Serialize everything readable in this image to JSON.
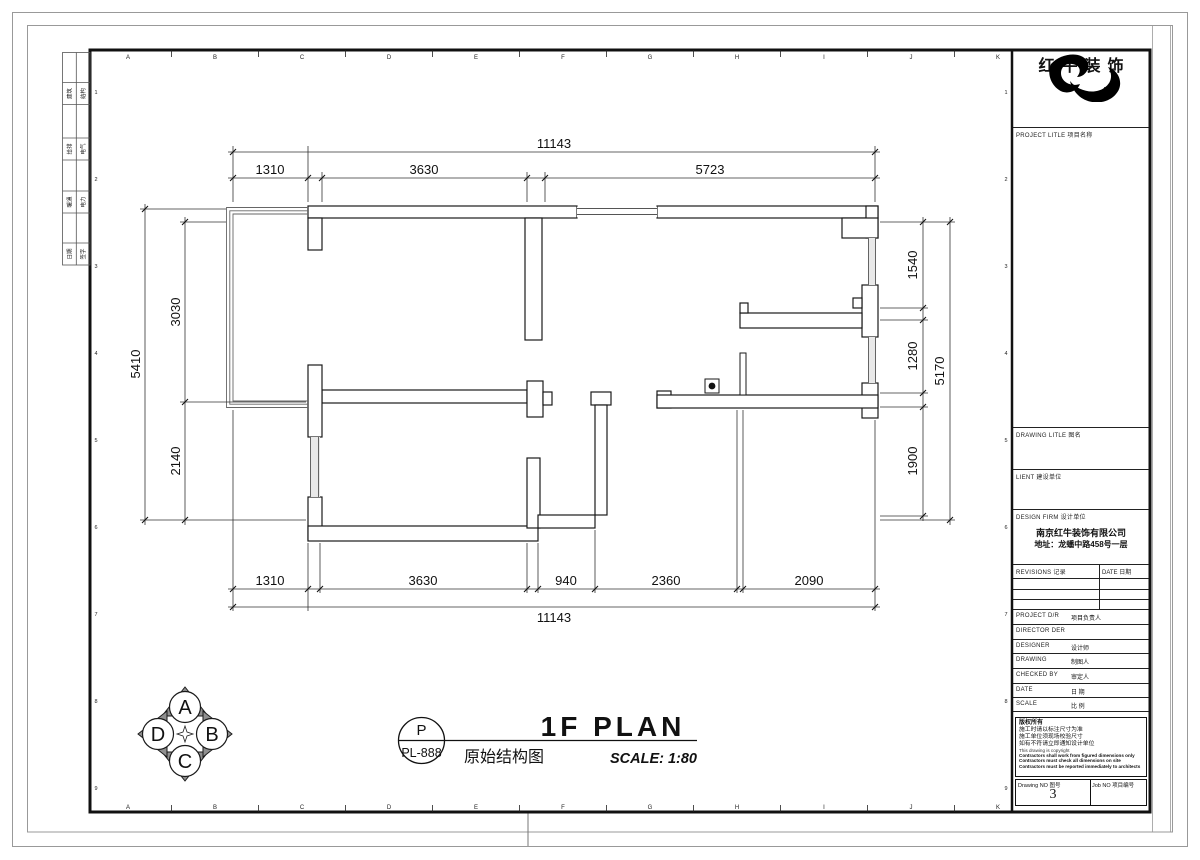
{
  "sheet": {
    "brand": "红牛装饰",
    "grid_letters": [
      "A",
      "B",
      "C",
      "D",
      "E",
      "F",
      "G",
      "H",
      "I",
      "J",
      "K"
    ],
    "row_numbers": [
      "1",
      "2",
      "3",
      "4",
      "5",
      "6",
      "7",
      "8",
      "9"
    ],
    "signature_strip": [
      [
        "建筑",
        "结构"
      ],
      [
        "给排",
        "电气"
      ],
      [
        "暖通",
        "电力"
      ],
      [
        "日期",
        "签字"
      ]
    ]
  },
  "plan": {
    "dim_top_total": "11143",
    "dim_top": [
      "1310",
      "3630",
      "5723"
    ],
    "dim_bottom": [
      "1310",
      "3630",
      "940",
      "2360",
      "2090"
    ],
    "dim_bottom_total": "11143",
    "dim_left_outer": "5410",
    "dim_left": [
      "3030",
      "2140"
    ],
    "dim_right": [
      "1540",
      "1280",
      "1900"
    ],
    "dim_right_outer": "5170"
  },
  "title_bar": {
    "ref_top": "P",
    "ref_bottom": "PL-888",
    "title_en": "1F PLAN",
    "title_cn": "原始结构图",
    "scale": "SCALE: 1:80"
  },
  "compass": {
    "top": "A",
    "right": "B",
    "bottom": "C",
    "left": "D"
  },
  "title_block": {
    "project_label": "PROJECT LITLE 项目名称",
    "drawing_label": "DRAWING LITLE 图名",
    "client_label": "LIENT 建设单位",
    "design_firm_label": "DESIGN FIRM 设计单位",
    "design_firm_name": "南京红牛装饰有限公司",
    "design_firm_addr": "地址：龙蟠中路458号一层",
    "revisions_label": "REVISIONS 记录",
    "date_col_label": "DATE 日期",
    "rows": [
      {
        "label": "PROJECT D/R",
        "cn": "项目负责人"
      },
      {
        "label": "DIRECTOR DER",
        "cn": ""
      },
      {
        "label": "DESIGNER",
        "cn": "设计师"
      },
      {
        "label": "DRAWING",
        "cn": "制图人"
      },
      {
        "label": "CHECKED BY",
        "cn": "审定人"
      },
      {
        "label": "DATE",
        "cn": "日  期"
      },
      {
        "label": "SCALE",
        "cn": "比  例"
      }
    ],
    "copyright_cn_title": "版权所有",
    "notes_cn": [
      "施工时请以标注尺寸为准",
      "施工单位须现场校验尺寸",
      "如有不符请立即通知设计单位"
    ],
    "copyright_en": "This drawing is copyright",
    "notes_en": [
      "Contractors shall work from figured dimensions only",
      "Contractors must check all dimensions on site",
      "Contractors must be reported immediately to architects"
    ],
    "drawing_no_label": "Drawing NO 图号",
    "drawing_no": "3",
    "job_no_label": "Job NO 项目编号"
  }
}
